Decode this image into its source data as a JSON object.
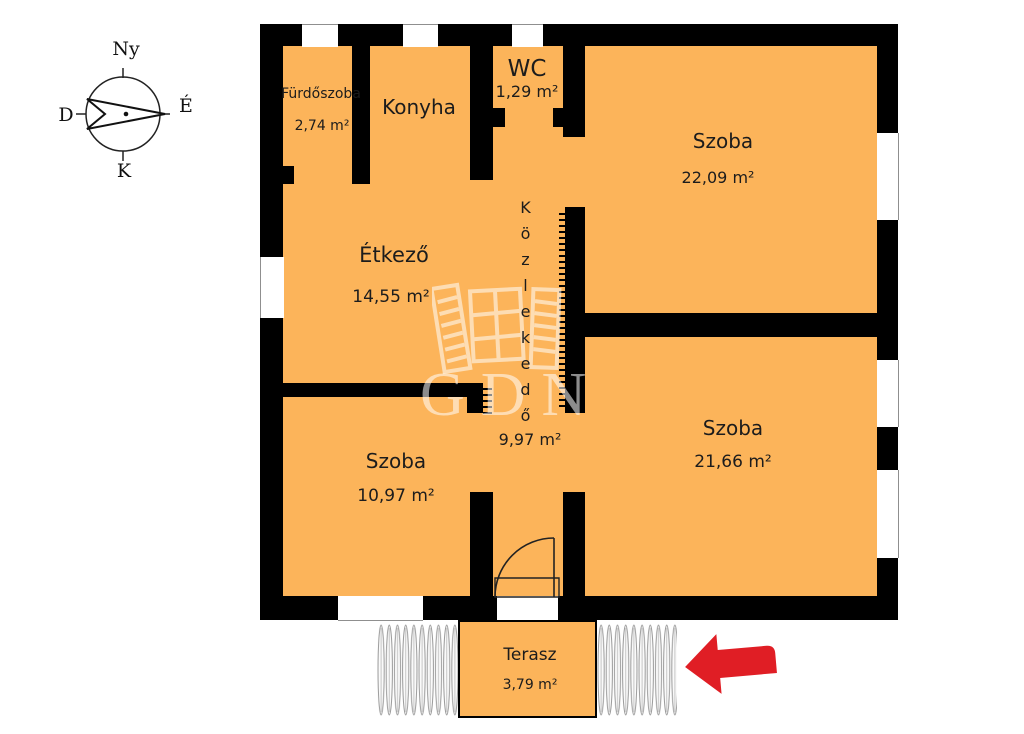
{
  "compass": {
    "west_label": "Ny",
    "north_label": "É",
    "south_label": "D",
    "east_label": "K"
  },
  "rooms": [
    {
      "id": "furdoszoba",
      "name": "Fürdőszoba",
      "area": "2,74 m²"
    },
    {
      "id": "konyha",
      "name": "Konyha",
      "area": ""
    },
    {
      "id": "wc",
      "name": "WC",
      "area": "1,29 m²"
    },
    {
      "id": "szoba-top",
      "name": "Szoba",
      "area": "22,09 m²"
    },
    {
      "id": "etkezo",
      "name": "Étkező",
      "area": "14,55 m²"
    },
    {
      "id": "kozlekedo",
      "name": "Közlekedő",
      "area": "9,97 m²"
    },
    {
      "id": "szoba-left",
      "name": "Szoba",
      "area": "10,97 m²"
    },
    {
      "id": "szoba-right",
      "name": "Szoba",
      "area": "21,66 m²"
    },
    {
      "id": "terasz",
      "name": "Terasz",
      "area": "3,79 m²"
    }
  ],
  "watermark": {
    "text": "GDN"
  },
  "colors": {
    "room_fill": "#FCB45A",
    "wall": "#000000",
    "arrow_red": "#E01E25",
    "hatch_line": "#999999"
  }
}
